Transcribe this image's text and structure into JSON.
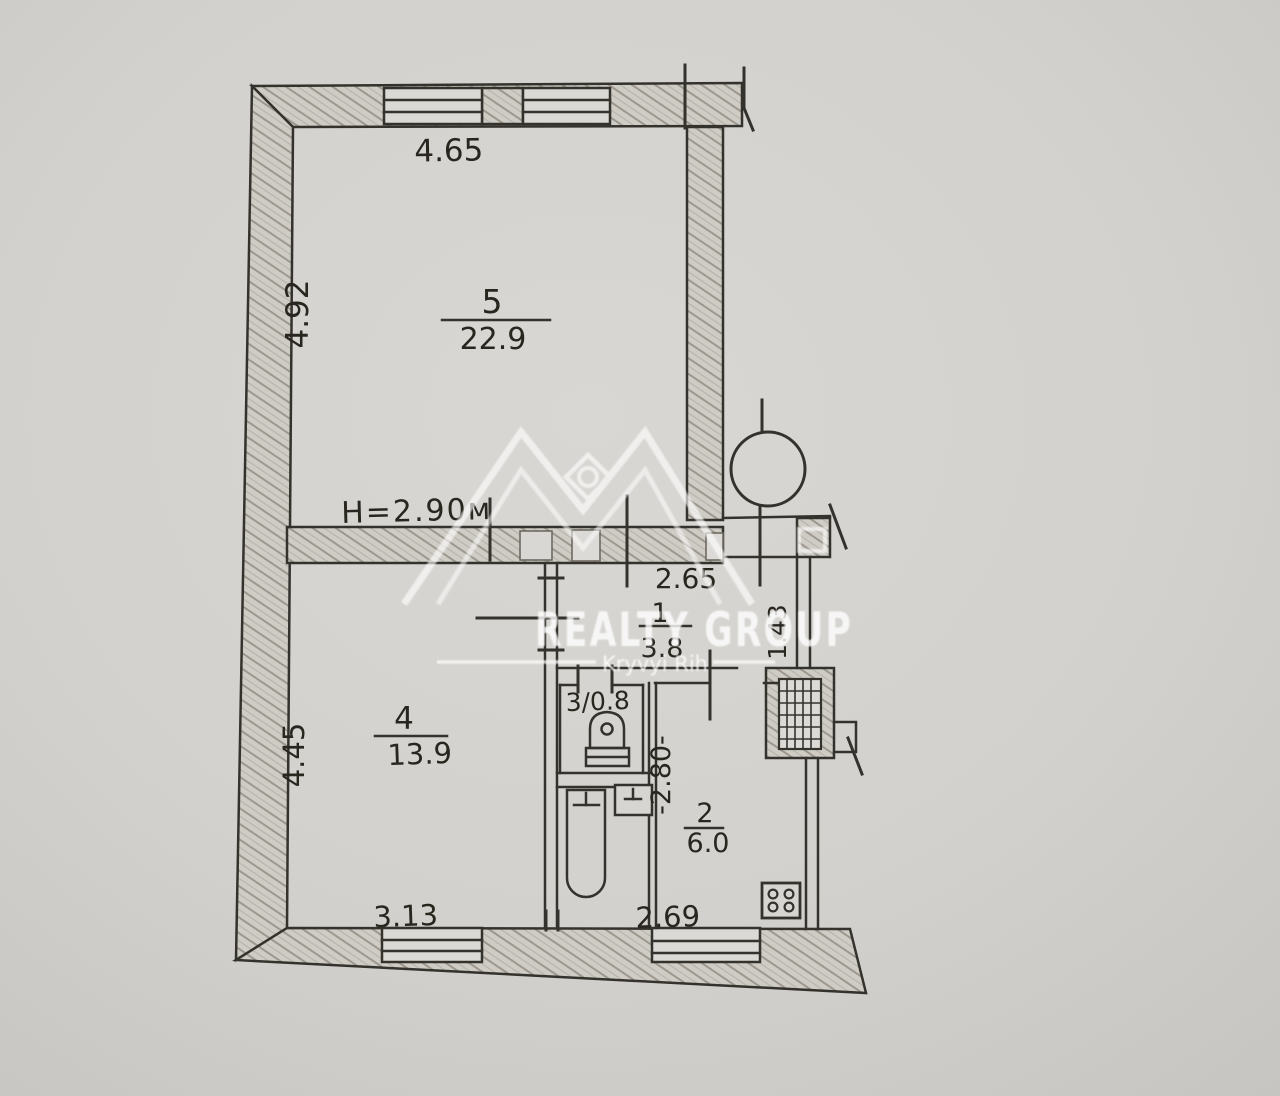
{
  "watermark": {
    "brand": "REALTY GROUP",
    "location": "Kryvyi Rih"
  },
  "plan": {
    "ceiling_height": "H=2.90м",
    "room5": {
      "number": "5",
      "area": "22.9",
      "dim_top": "4.65",
      "dim_left": "4.92"
    },
    "room4": {
      "number": "4",
      "area": "13.9",
      "dim_left": "4.45",
      "dim_bottom": "3.13"
    },
    "room1": {
      "number": "1",
      "area": "3.8",
      "dim_top": "2.65",
      "dim_right": "1.43"
    },
    "room3": {
      "label": "3/0.8"
    },
    "room2": {
      "number": "2",
      "area": "6.0",
      "dim_left": "-2.80-",
      "dim_bottom": "2.69"
    }
  }
}
